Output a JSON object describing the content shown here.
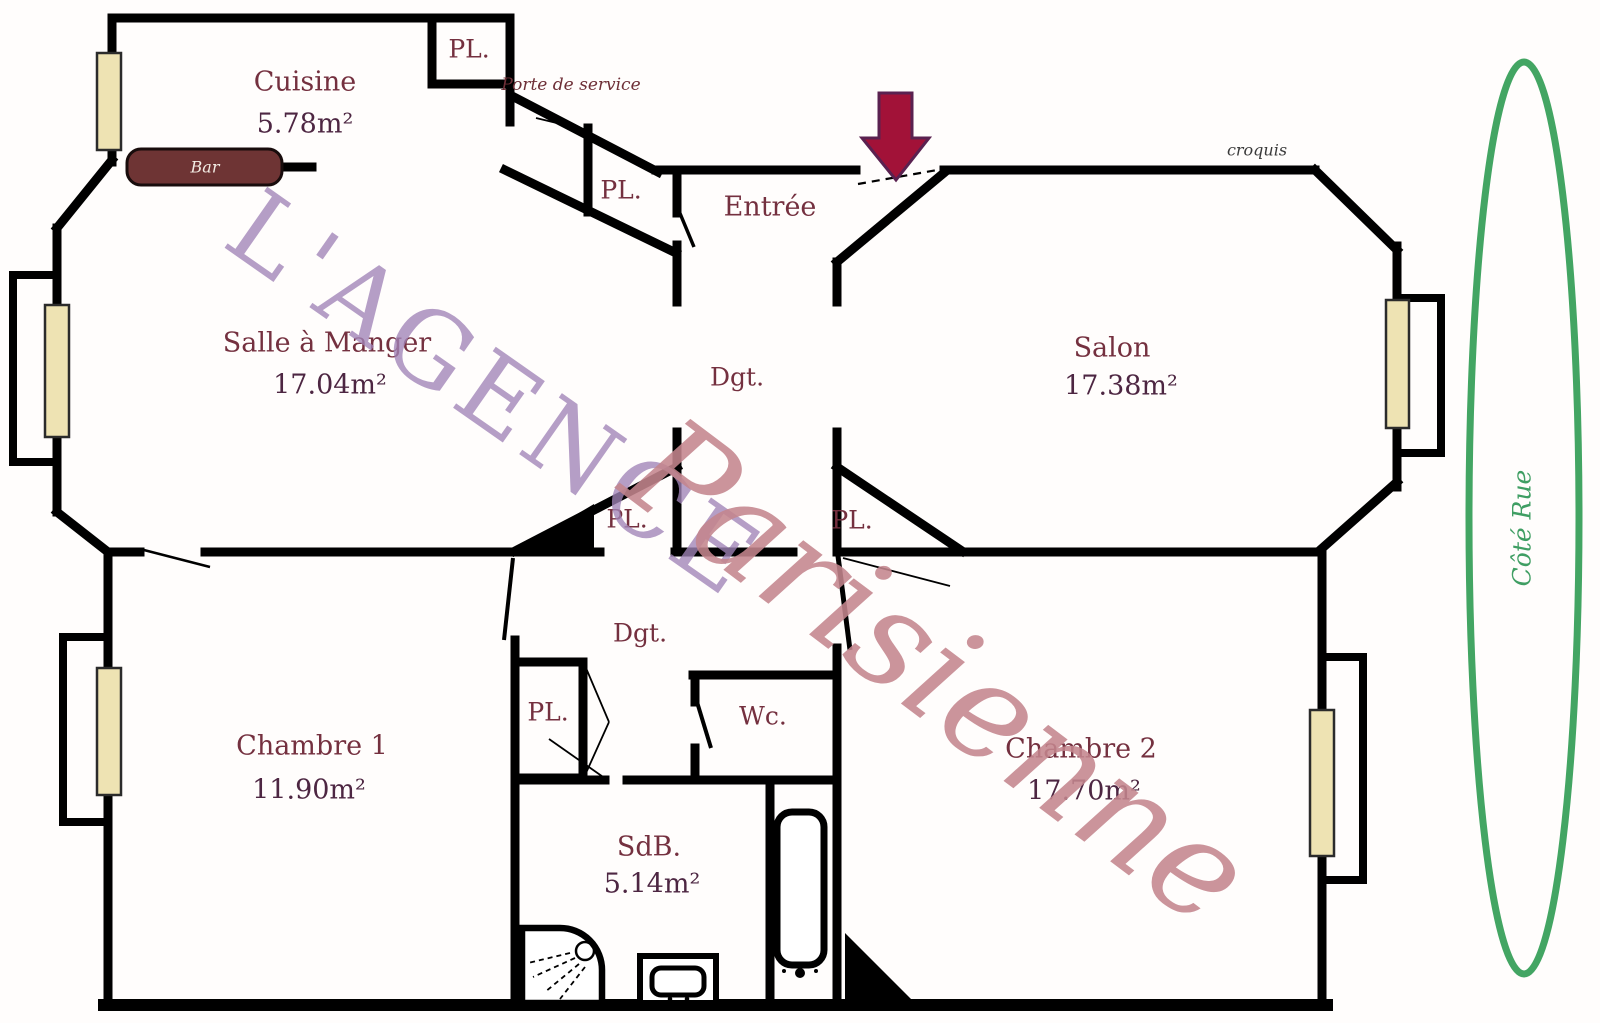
{
  "watermark": {
    "line1": "L'AGENCE",
    "line2": "Parisienne"
  },
  "annotations": {
    "croquis": "croquis",
    "porte_de_service": "Porte de service",
    "cote_rue": "Côté Rue",
    "bar": "Bar",
    "closet": "PL.",
    "hallway": "Dgt."
  },
  "rooms": {
    "cuisine": {
      "name": "Cuisine",
      "area": "5.78m²"
    },
    "salle_a_manger": {
      "name": "Salle à Manger",
      "area": "17.04m²"
    },
    "salon": {
      "name": "Salon",
      "area": "17.38m²"
    },
    "entree": {
      "name": "Entrée"
    },
    "chambre1": {
      "name": "Chambre 1",
      "area": "11.90m²"
    },
    "chambre2": {
      "name": "Chambre 2",
      "area": "17.70m²"
    },
    "salle_de_bain": {
      "name": "SdB.",
      "area": "5.14m²"
    },
    "wc": {
      "name": "Wc."
    }
  },
  "colors": {
    "walls": "#000000",
    "room_label": "#74303f",
    "area_label": "#4d2642",
    "watermark_serif": "#a184b8",
    "watermark_script": "#c4868e",
    "street_side_green": "#43a563",
    "window_fill": "#eee3b3",
    "bar_fill": "#6e3434",
    "arrow_fill": "#a21238"
  }
}
